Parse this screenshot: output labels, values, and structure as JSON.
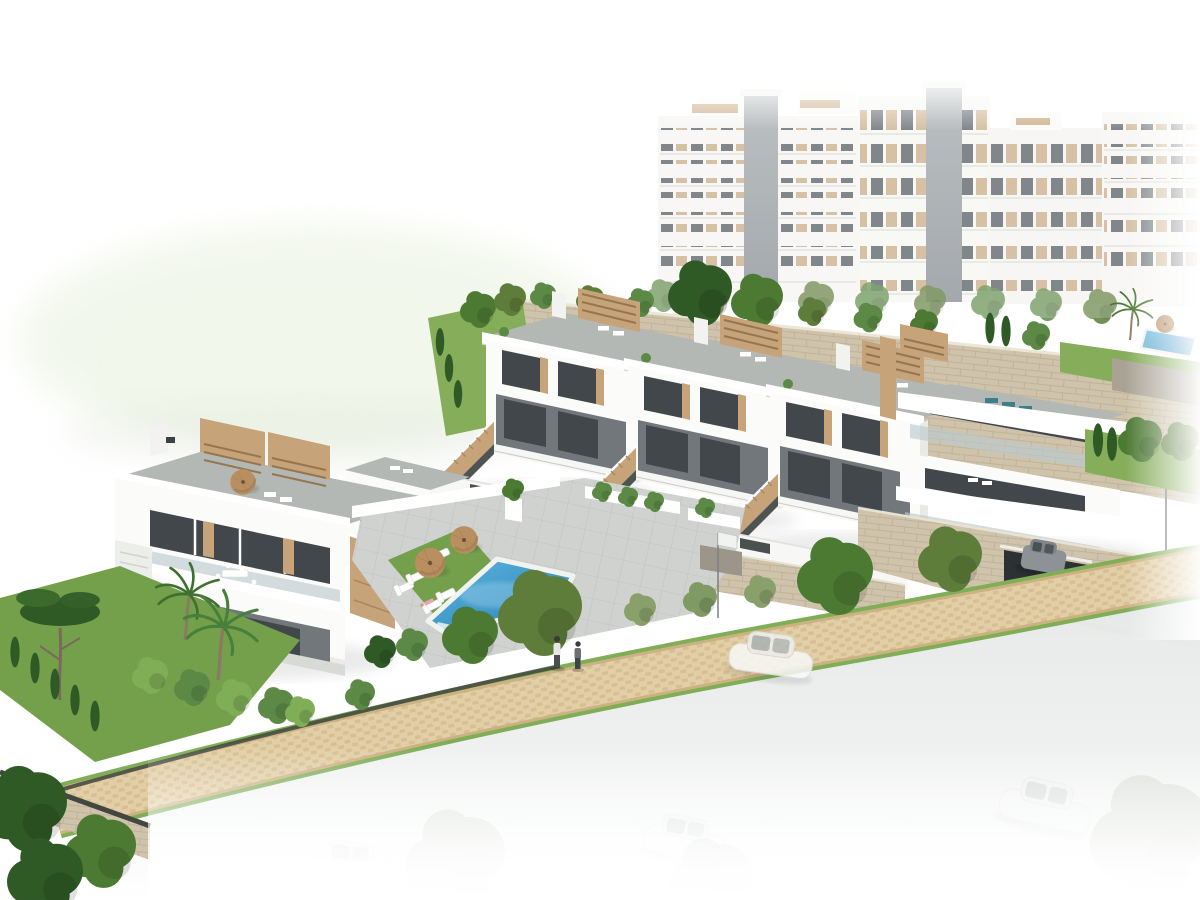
{
  "meta": {
    "type": "architectural-3d-render",
    "width": 1200,
    "height": 900
  },
  "scene": {
    "description": "Aerial 3D architectural rendering of a white Mediterranean residential development: terraced townhouses with rooftop terraces and wooden pergolas, a detached villa block, a communal swimming pool with sun loungers and parasols, landscaped gardens with palms and cypresses, a beige stone retaining wall with apartment blocks above, a cobblestone promenade with two pedestrians, and a road with cars fading into a white background",
    "background": "white studio backdrop with faint green hill at upper left",
    "elements": [
      {
        "name": "apartment-complex",
        "note": "white multi-storey blocks with tan panels and dark glazing, upper right, fading to white"
      },
      {
        "name": "stone-retaining-wall",
        "note": "beige rough stone wall running diagonally below the apartments"
      },
      {
        "name": "townhouse-row",
        "note": "three-plus white terraced units with tan side stairs, roof terraces and slatted pergolas"
      },
      {
        "name": "corner-building",
        "note": "faceted white building with stacked glass balconies and teal roof loungers, right side, garage in stone base"
      },
      {
        "name": "villa-block",
        "note": "white villa with roof terrace, parasol, pergola slats, balcony dining set, left side"
      },
      {
        "name": "swimming-pool",
        "note": "blue communal pool with white coping and corner steps"
      },
      {
        "name": "pool-lawn",
        "note": "green lawn strip with white sun loungers and two tan parasols"
      },
      {
        "name": "secondary-pool",
        "note": "small blue pool on upper right terrace with palm and parasol"
      },
      {
        "name": "promenade",
        "note": "tan cobblestone path with grass edges, hedges and trees"
      },
      {
        "name": "pedestrians",
        "note": "two people walking on the promenade"
      },
      {
        "name": "road",
        "note": "light gray street fading to white with parked car silhouettes"
      },
      {
        "name": "flag",
        "note": "small white flag on a pole near the center"
      }
    ],
    "counts": {
      "pool_sun_loungers": 6,
      "pool_parasols": 2,
      "roof_parasols": 1,
      "pedestrians": 2,
      "clear_cars": 2,
      "faded_parked_cars": 3,
      "flags": 1,
      "pools": 2
    }
  },
  "palette": {
    "facade_white": "#fbfbfa",
    "facade_shade": "#e9eae6",
    "recess_shadow": "#71777b",
    "glazing_dark": "#41474b",
    "wood_tan": "#c6a379",
    "wood_dark": "#96764f",
    "terrace_gray": "#b3b8b4",
    "paving_light": "#cfd2ce",
    "paving_line": "#bdc1bd",
    "stone_beige": "#cfc3ab",
    "stone_line": "#b5a78c",
    "pool_blue_light": "#58b1de",
    "pool_blue_deep": "#2b86ba",
    "lawn_green": "#74a04c",
    "lawn_light": "#85ad5a",
    "tree_green": "#4c7a33",
    "tree_dark": "#2f5a26",
    "tree_olive": "#5e7d3a",
    "tree_light": "#7fae57",
    "hedge_green": "#5c8a46",
    "path_tan": "#e3cfa6",
    "path_brick": "#d6bf93",
    "path_edge": "#cbb283",
    "road_gray": "#e6e8e7",
    "car_gray": "#8d9296",
    "fence_dark": "#424740",
    "metal_gray": "#70767a",
    "glass_blue": "#bcc9ce",
    "hill_green": "#e9f2df",
    "umbrella_tan": "#b98f62",
    "teal_lounger": "#3e7d8a",
    "person_shirt": "#e8e6e2",
    "person_pants": "#4a4f52",
    "towel_pink": "#e8a7b0"
  }
}
